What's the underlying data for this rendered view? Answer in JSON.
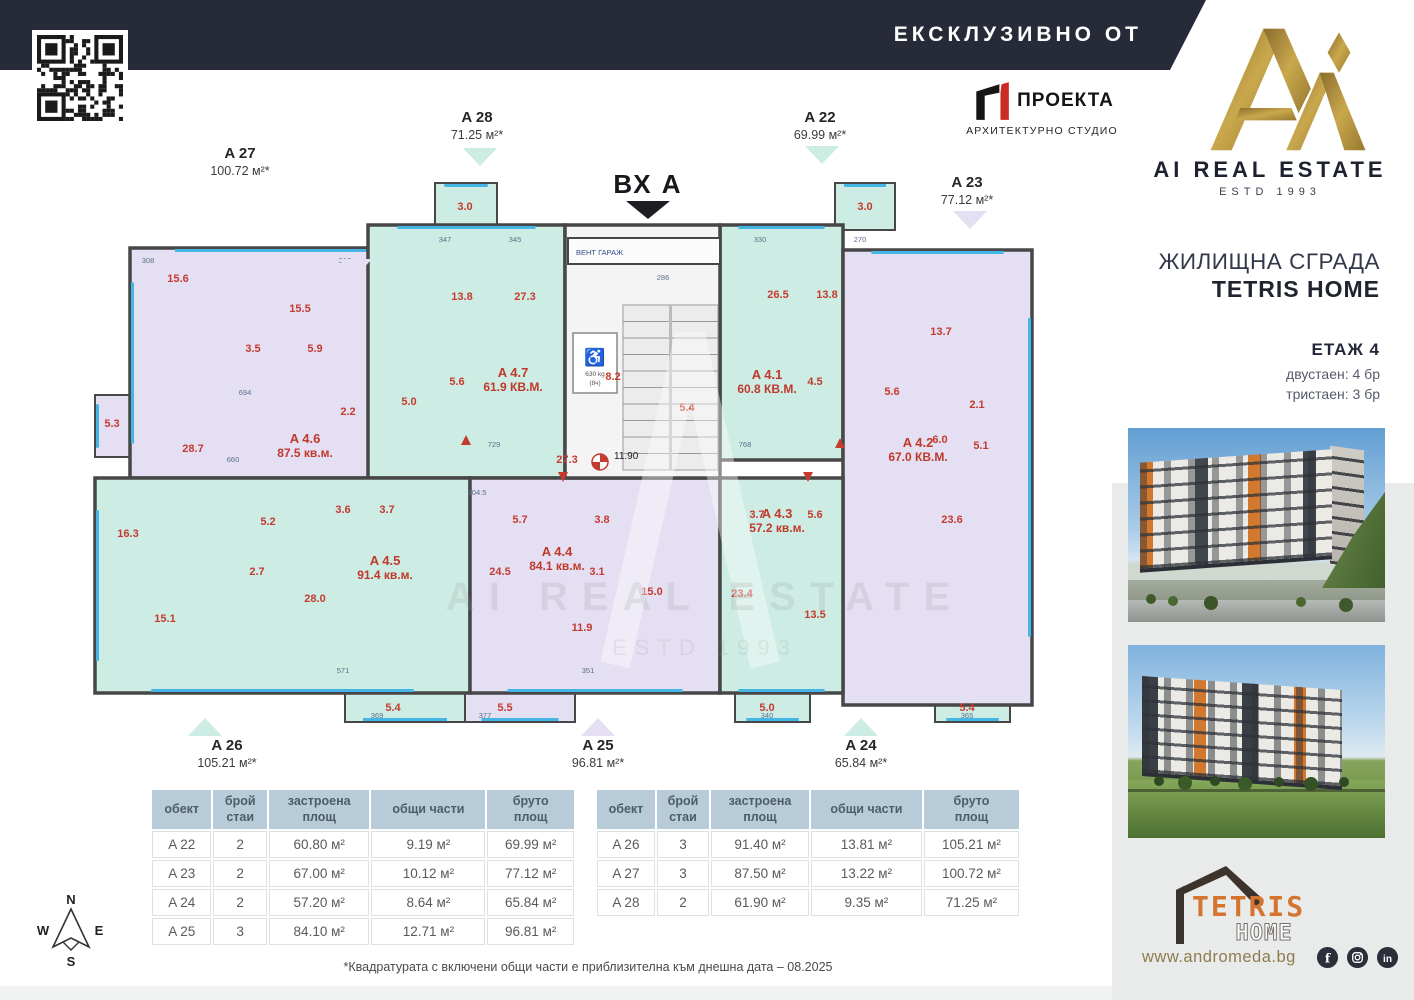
{
  "header": {
    "banner": "ЕКСКЛУЗИВНО ОТ"
  },
  "proekta": {
    "name": "ПРОЕКТА",
    "subtitle": "АРХИТЕКТУРНО СТУДИО"
  },
  "brand": {
    "title": "AI REAL ESTATE",
    "estd": "ESTD 1993"
  },
  "sidebar": {
    "building_title": "ЖИЛИЩНА СГРАДА",
    "building_name": "TETRIS HOME",
    "floor": "ЕТАЖ 4",
    "stats": [
      "двустаен: 4 бр",
      "тристаен: 3 бр"
    ],
    "tetris_word": "TETRIS",
    "tetris_home": "HOME",
    "website": "www.andromeda.bg",
    "social": [
      "facebook",
      "instagram",
      "linkedin"
    ]
  },
  "plan": {
    "colors": {
      "mint": "#cdece3",
      "lavender": "#e4dff2",
      "wall": "#474747",
      "win": "#45b5e5",
      "red": "#c43b30"
    },
    "entrance": {
      "label": "ВХ А",
      "x": 633,
      "y": 88
    },
    "watermark": {
      "l1": "AI REAL ESTATE",
      "l2": "ESTD 1993"
    },
    "core": {
      "x": 550,
      "y": 120,
      "w": 155,
      "h": 253,
      "stairs": {
        "x": 608,
        "y": 200,
        "w": 95,
        "h": 165
      },
      "vent": {
        "x": 553,
        "y": 133,
        "w": 152,
        "h": 26,
        "label": "ВЕНТ ГАРАЖ"
      },
      "lift": {
        "x": 558,
        "y": 228,
        "w": 44,
        "h": 60,
        "symbol": "♿",
        "capacity": "630 kg",
        "persons": "(8ч)"
      }
    },
    "marker": {
      "x": 585,
      "y": 357,
      "level": "11.90"
    },
    "apartments": [
      {
        "x": 115,
        "y": 143,
        "w": 300,
        "h": 230,
        "fill": "lavender",
        "label": "A 4.6",
        "area": "87.5 кв.м.",
        "lx": 290,
        "ly": 338,
        "win": [
          "top",
          "left"
        ]
      },
      {
        "x": 353,
        "y": 120,
        "w": 197,
        "h": 253,
        "fill": "mint",
        "label": "A 4.7",
        "area": "61.9 КВ.М.",
        "lx": 498,
        "ly": 272,
        "win": [
          "top"
        ]
      },
      {
        "x": 705,
        "y": 120,
        "w": 123,
        "h": 235,
        "fill": "mint",
        "label": "A 4.1",
        "area": "60.8 КВ.М.",
        "lx": 752,
        "ly": 274,
        "win": [
          "top"
        ]
      },
      {
        "x": 828,
        "y": 145,
        "w": 189,
        "h": 455,
        "fill": "lavender",
        "label": "A 4.2",
        "area": "67.0 КВ.М.",
        "lx": 903,
        "ly": 342,
        "win": [
          "top",
          "right"
        ]
      },
      {
        "x": 80,
        "y": 373,
        "w": 375,
        "h": 215,
        "fill": "mint",
        "label": "A 4.5",
        "area": "91.4 кв.м.",
        "lx": 370,
        "ly": 460,
        "win": [
          "left",
          "bottom"
        ]
      },
      {
        "x": 455,
        "y": 373,
        "w": 250,
        "h": 215,
        "fill": "lavender",
        "label": "A 4.4",
        "area": "84.1 кв.м.",
        "lx": 542,
        "ly": 451,
        "win": [
          "bottom"
        ]
      },
      {
        "x": 705,
        "y": 373,
        "w": 123,
        "h": 215,
        "fill": "mint",
        "label": "A 4.3",
        "area": "57.2 кв.м.",
        "lx": 762,
        "ly": 413,
        "win": [
          "bottom"
        ]
      }
    ],
    "extras": [
      {
        "x": 420,
        "y": 78,
        "w": 62,
        "h": 47,
        "fill": "mint",
        "win": [
          "top"
        ]
      },
      {
        "x": 820,
        "y": 78,
        "w": 60,
        "h": 47,
        "fill": "mint",
        "win": [
          "top"
        ]
      },
      {
        "x": 80,
        "y": 290,
        "w": 35,
        "h": 62,
        "fill": "lavender",
        "win": [
          "left"
        ]
      },
      {
        "x": 330,
        "y": 588,
        "w": 120,
        "h": 29,
        "fill": "mint",
        "win": [
          "bottom"
        ]
      },
      {
        "x": 450,
        "y": 588,
        "w": 110,
        "h": 29,
        "fill": "lavender",
        "win": [
          "bottom"
        ]
      },
      {
        "x": 720,
        "y": 588,
        "w": 75,
        "h": 29,
        "fill": "mint",
        "win": [
          "bottom"
        ]
      },
      {
        "x": 920,
        "y": 588,
        "w": 75,
        "h": 29,
        "fill": "mint",
        "win": [
          "bottom"
        ]
      }
    ],
    "rooms": [
      {
        "t": "15.6",
        "x": 163,
        "y": 177
      },
      {
        "t": "15.5",
        "x": 285,
        "y": 207
      },
      {
        "t": "3.5",
        "x": 238,
        "y": 247
      },
      {
        "t": "5.9",
        "x": 300,
        "y": 247
      },
      {
        "t": "28.7",
        "x": 178,
        "y": 347
      },
      {
        "t": "2.2",
        "x": 333,
        "y": 310
      },
      {
        "t": "5.3",
        "x": 97,
        "y": 322
      },
      {
        "t": "13.8",
        "x": 447,
        "y": 195
      },
      {
        "t": "27.3",
        "x": 510,
        "y": 195
      },
      {
        "t": "5.6",
        "x": 442,
        "y": 280
      },
      {
        "t": "5.0",
        "x": 394,
        "y": 300
      },
      {
        "t": "8.2",
        "x": 598,
        "y": 275
      },
      {
        "t": "5.4",
        "x": 672,
        "y": 306
      },
      {
        "t": "26.5",
        "x": 763,
        "y": 193
      },
      {
        "t": "13.8",
        "x": 812,
        "y": 193
      },
      {
        "t": "4.5",
        "x": 800,
        "y": 280
      },
      {
        "t": "3.0",
        "x": 450,
        "y": 105
      },
      {
        "t": "3.0",
        "x": 850,
        "y": 105
      },
      {
        "t": "13.7",
        "x": 926,
        "y": 230
      },
      {
        "t": "2.1",
        "x": 962,
        "y": 303
      },
      {
        "t": "6.0",
        "x": 925,
        "y": 338
      },
      {
        "t": "5.1",
        "x": 966,
        "y": 344
      },
      {
        "t": "23.6",
        "x": 937,
        "y": 418
      },
      {
        "t": "5.6",
        "x": 877,
        "y": 290
      },
      {
        "t": "16.3",
        "x": 113,
        "y": 432
      },
      {
        "t": "15.1",
        "x": 150,
        "y": 517
      },
      {
        "t": "28.0",
        "x": 300,
        "y": 497
      },
      {
        "t": "5.2",
        "x": 253,
        "y": 420
      },
      {
        "t": "2.7",
        "x": 242,
        "y": 470
      },
      {
        "t": "3.6",
        "x": 328,
        "y": 408
      },
      {
        "t": "3.7",
        "x": 372,
        "y": 408
      },
      {
        "t": "24.5",
        "x": 485,
        "y": 470
      },
      {
        "t": "5.7",
        "x": 505,
        "y": 418
      },
      {
        "t": "3.8",
        "x": 587,
        "y": 418
      },
      {
        "t": "3.1",
        "x": 582,
        "y": 470
      },
      {
        "t": "15.0",
        "x": 637,
        "y": 490
      },
      {
        "t": "11.9",
        "x": 567,
        "y": 526
      },
      {
        "t": "23.4",
        "x": 727,
        "y": 492
      },
      {
        "t": "13.5",
        "x": 800,
        "y": 513
      },
      {
        "t": "3.7",
        "x": 742,
        "y": 413
      },
      {
        "t": "5.6",
        "x": 800,
        "y": 413
      },
      {
        "t": "27.3",
        "x": 552,
        "y": 358
      },
      {
        "t": "5.4",
        "x": 378,
        "y": 606
      },
      {
        "t": "5.5",
        "x": 490,
        "y": 606
      },
      {
        "t": "5.0",
        "x": 752,
        "y": 606
      },
      {
        "t": "5.4",
        "x": 952,
        "y": 606
      }
    ],
    "dims": [
      {
        "t": "308",
        "x": 133,
        "y": 158
      },
      {
        "t": "516",
        "x": 330,
        "y": 158
      },
      {
        "t": "347",
        "x": 430,
        "y": 137
      },
      {
        "t": "345",
        "x": 500,
        "y": 137
      },
      {
        "t": "286",
        "x": 648,
        "y": 175
      },
      {
        "t": "330",
        "x": 745,
        "y": 137
      },
      {
        "t": "270",
        "x": 845,
        "y": 137
      },
      {
        "t": "729",
        "x": 479,
        "y": 342
      },
      {
        "t": "768",
        "x": 730,
        "y": 342
      },
      {
        "t": "694",
        "x": 230,
        "y": 290
      },
      {
        "t": "660",
        "x": 218,
        "y": 357
      },
      {
        "t": "304.5",
        "x": 462,
        "y": 390
      },
      {
        "t": "571",
        "x": 328,
        "y": 568
      },
      {
        "t": "351",
        "x": 573,
        "y": 568
      },
      {
        "t": "369",
        "x": 362,
        "y": 613
      },
      {
        "t": "377",
        "x": 470,
        "y": 613
      },
      {
        "t": "340",
        "x": 752,
        "y": 613
      },
      {
        "t": "365",
        "x": 952,
        "y": 613
      }
    ],
    "marks": [
      {
        "x": 451,
        "y": 335,
        "d": "up"
      },
      {
        "x": 548,
        "y": 372,
        "d": "down"
      },
      {
        "x": 825,
        "y": 338,
        "d": "up"
      },
      {
        "x": 793,
        "y": 372,
        "d": "down"
      }
    ],
    "callouts": [
      {
        "label": "A 27",
        "area": "100.72 м²*",
        "tri": "lavender",
        "dir": "down",
        "tx": 225,
        "ty": 53,
        "px": 340,
        "py": 163
      },
      {
        "label": "A 28",
        "area": "71.25 м²*",
        "tri": "mint",
        "dir": "down",
        "tx": 462,
        "ty": 17,
        "px": 465,
        "py": 52
      },
      {
        "label": "A 22",
        "area": "69.99 м²*",
        "tri": "mint",
        "dir": "down",
        "tx": 805,
        "ty": 17,
        "px": 807,
        "py": 50
      },
      {
        "label": "A 23",
        "area": "77.12 м²*",
        "tri": "lavender",
        "dir": "down",
        "tx": 952,
        "ty": 82,
        "px": 955,
        "py": 115
      },
      {
        "label": "A 26",
        "area": "105.21 м²*",
        "tri": "mint",
        "dir": "up",
        "tx": 212,
        "ty": 645,
        "px": 190,
        "py": 622
      },
      {
        "label": "A 25",
        "area": "96.81 м²*",
        "tri": "lavender",
        "dir": "up",
        "tx": 583,
        "ty": 645,
        "px": 583,
        "py": 622
      },
      {
        "label": "A 24",
        "area": "65.84 м²*",
        "tri": "mint",
        "dir": "up",
        "tx": 846,
        "ty": 645,
        "px": 846,
        "py": 622
      }
    ]
  },
  "tables": [
    {
      "headers": [
        "обект",
        "брой\nстаи",
        "застроена\nплощ",
        "общи части",
        "бруто\nплощ"
      ],
      "rows": [
        [
          "A 22",
          "2",
          "60.80 м²",
          "9.19 м²",
          "69.99 м²"
        ],
        [
          "A 23",
          "2",
          "67.00 м²",
          "10.12 м²",
          "77.12 м²"
        ],
        [
          "A 24",
          "2",
          "57.20 м²",
          "8.64 м²",
          "65.84 м²"
        ],
        [
          "A 25",
          "3",
          "84.10 м²",
          "12.71 м²",
          "96.81 м²"
        ]
      ]
    },
    {
      "headers": [
        "обект",
        "брой\nстаи",
        "застроена\nплощ",
        "общи части",
        "бруто\nплощ"
      ],
      "rows": [
        [
          "A 26",
          "3",
          "91.40 м²",
          "13.81 м²",
          "105.21 м²"
        ],
        [
          "A 27",
          "3",
          "87.50 м²",
          "13.22 м²",
          "100.72 м²"
        ],
        [
          "A 28",
          "2",
          "61.90 м²",
          "9.35 м²",
          "71.25 м²"
        ]
      ]
    }
  ],
  "compass": {
    "n": "N",
    "s": "S",
    "e": "E",
    "w": "W"
  },
  "footnote": "*Квадратурата с включени общи части е приблизителна към днешна дата – 08.2025"
}
